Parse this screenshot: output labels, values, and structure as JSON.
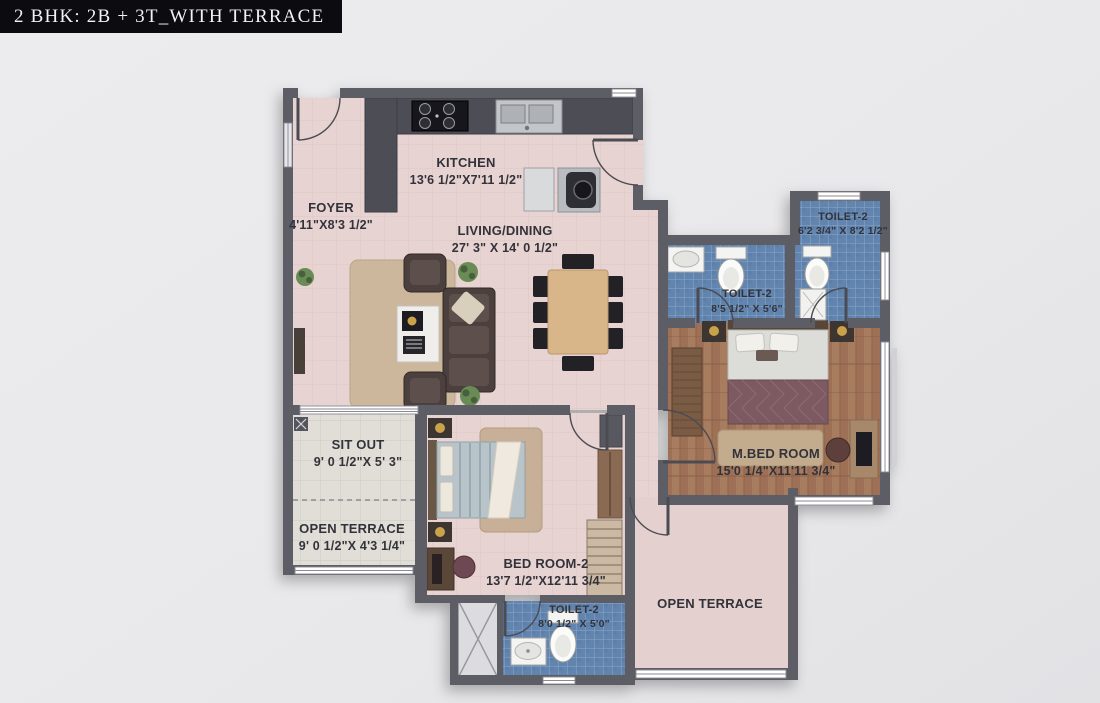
{
  "header": {
    "title": "2 BHK: 2B + 3T_WITH TERRACE"
  },
  "rooms": {
    "kitchen": {
      "name": "KITCHEN",
      "dims": "13'6 1/2\"X7'11 1/2\""
    },
    "foyer": {
      "name": "FOYER",
      "dims": "4'11\"X8'3 1/2\""
    },
    "living": {
      "name": "LIVING/DINING",
      "dims": "27' 3\" X 14' 0 1/2\""
    },
    "toilet_top": {
      "name": "TOILET-2",
      "dims": "6'2 3/4\" X 8'2 1/2\""
    },
    "toilet_mid": {
      "name": "TOILET-2",
      "dims": "8'5 1/2\" X 5'6\""
    },
    "master": {
      "name": "M.BED ROOM",
      "dims": "15'0 1/4\"X11'11 3/4\""
    },
    "sitout": {
      "name": "SIT OUT",
      "dims": "9' 0 1/2\"X 5' 3\""
    },
    "terrace_left": {
      "name": "OPEN TERRACE",
      "dims": "9' 0 1/2\"X 4'3 1/4\""
    },
    "bedroom2": {
      "name": "BED ROOM-2",
      "dims": "13'7 1/2\"X12'11 3/4\""
    },
    "toilet_bottom": {
      "name": "TOILET-2",
      "dims": "8'0 1/2\" X 5'0\""
    },
    "terrace_right": {
      "name": "OPEN TERRACE"
    }
  },
  "colors": {
    "banner_bg": "#0b0b10",
    "banner_text": "#f2f2f2",
    "wall": "#5d5d65",
    "floor_main": "#e7d3d1",
    "floor_wood": "#a87c5f",
    "floor_tile_blue": "#6285af",
    "floor_terrace_tile": "#e0ded7",
    "kitchen_counter": "#4d4d55",
    "label_text": "#33333a"
  }
}
